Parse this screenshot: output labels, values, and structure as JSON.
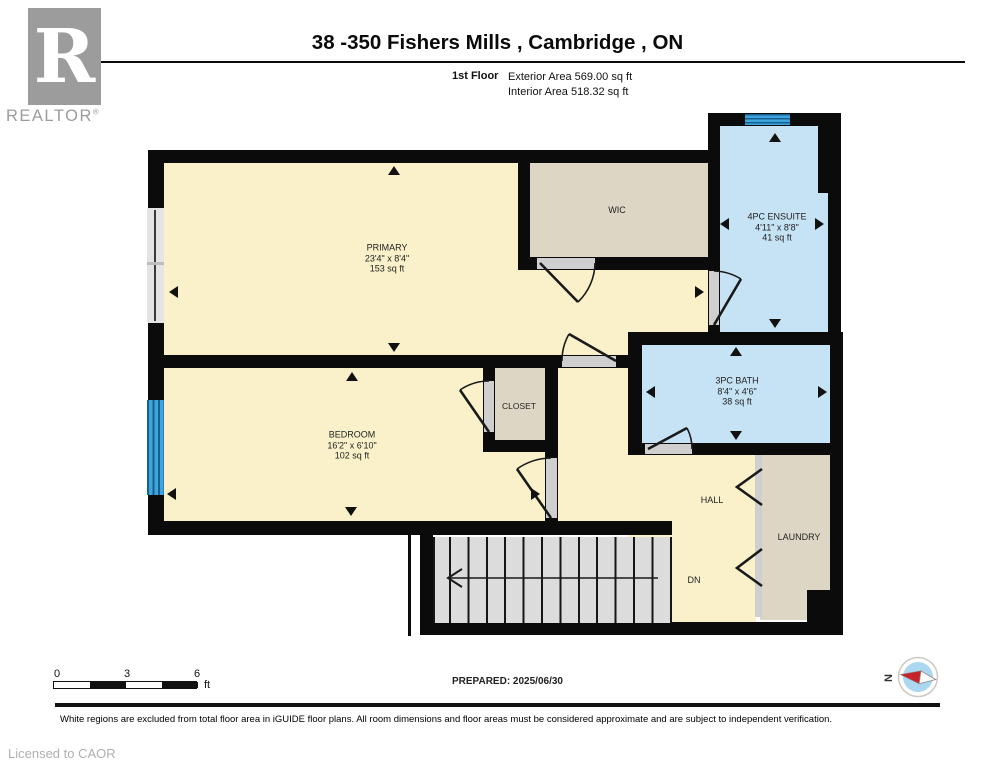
{
  "header": {
    "brand": {
      "logo_letter": "R",
      "logo_text": "REALTOR",
      "registered_mark": "®"
    },
    "title": "38 -350 Fishers Mills , Cambridge , ON",
    "floor_label": "1st Floor",
    "exterior_area": "Exterior Area 569.00 sq ft",
    "interior_area": "Interior Area 518.32 sq ft"
  },
  "rooms": {
    "primary": {
      "name": "PRIMARY",
      "dims": "23'4\" x 8'4\"",
      "area": "153 sq ft"
    },
    "wic": {
      "name": "WIC"
    },
    "ensuite": {
      "name": "4PC ENSUITE",
      "dims": "4'11\" x 8'8\"",
      "area": "41 sq ft"
    },
    "bath": {
      "name": "3PC BATH",
      "dims": "8'4\" x 4'6\"",
      "area": "38 sq ft"
    },
    "bedroom": {
      "name": "BEDROOM",
      "dims": "16'2\" x 6'10\"",
      "area": "102 sq ft"
    },
    "closet": {
      "name": "CLOSET"
    },
    "hall": {
      "name": "HALL"
    },
    "laundry": {
      "name": "LAUNDRY"
    },
    "stairs": {
      "label": "DN"
    }
  },
  "scale_bar": {
    "tick0": "0",
    "tick1": "3",
    "tick2": "6",
    "unit": "ft"
  },
  "prepared": "PREPARED: 2025/06/30",
  "compass": {
    "north_label": "N"
  },
  "footer": {
    "disclaimer": "White regions are excluded from total floor area in iGUIDE floor plans. All room dimensions and floor areas must be considered approximate and are subject to independent verification.",
    "license": "Licensed to CAOR"
  },
  "colors": {
    "room_yellow": "#faf1ca",
    "room_tan": "#ddd6c4",
    "room_blue": "#c6e3f5",
    "window_blue": "#3fa3dc",
    "wall_black": "#0b0b0b",
    "stair_gray": "#dcdcdc",
    "compass_red": "#c8242b",
    "logo_gray": "#9c9c9c"
  }
}
